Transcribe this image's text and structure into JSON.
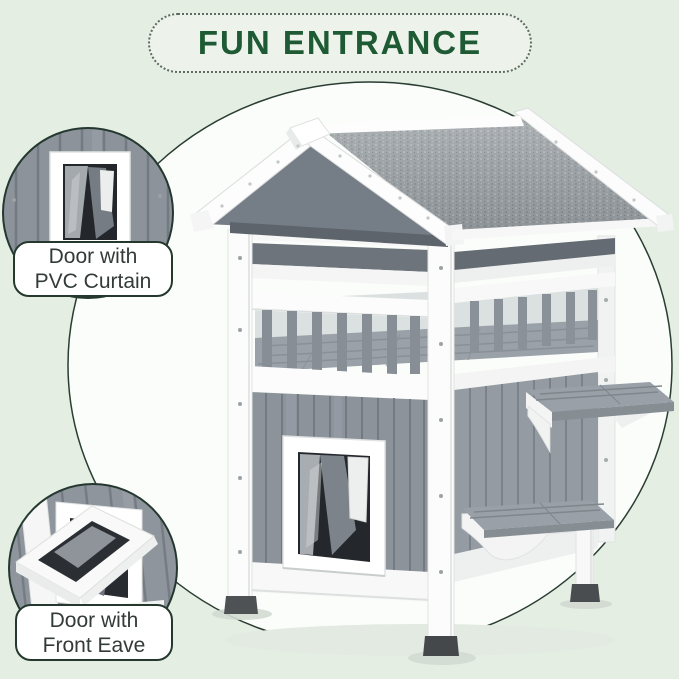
{
  "title": {
    "text": "FUN ENTRANCE"
  },
  "callouts": [
    {
      "name": "door-with-pvc-curtain",
      "label_line1": "Door with",
      "label_line2": "PVC Curtain"
    },
    {
      "name": "door-with-front-eave",
      "label_line1": "Door with",
      "label_line2": "Front Eave"
    }
  ],
  "colors": {
    "page_background": "#e4eee3",
    "spotlight_fill": "#fbfdfa",
    "outline_dark": "#2a3d32",
    "title_green": "#1e5a33",
    "pill_background": "#edf2eb",
    "label_background": "#ffffff",
    "label_text": "#333b38",
    "house_siding_gray": "#8d939b",
    "roof_asphalt_gray": "#9ba1a5",
    "wood_trim_white": "#fafbfa",
    "foot_dark_gray": "#4a4d50"
  }
}
